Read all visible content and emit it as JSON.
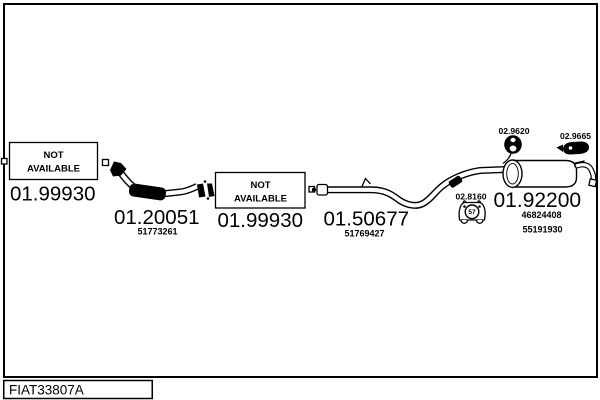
{
  "colors": {
    "ink": "#000000",
    "background": "#ffffff"
  },
  "footer": {
    "drawing_code": "FIAT33807A"
  },
  "not_available": {
    "line1": "NOT",
    "line2": "AVAILABLE"
  },
  "parts": {
    "front_flange": {
      "code": "01.99930"
    },
    "front_pipe": {
      "code": "01.20051",
      "oem": "51773261"
    },
    "mid_gasket": {
      "code": "01.99930"
    },
    "centre_pipe": {
      "code": "01.50677",
      "oem": "51769427"
    },
    "rear_silencer": {
      "code": "01.92200",
      "oem_1": "46824408",
      "oem_2": "55191930"
    },
    "rubber_grommet": {
      "code": "02.9620"
    },
    "clamp": {
      "code": "02.9665"
    },
    "rubber_hanger": {
      "code": "02.8160",
      "stamp": "57"
    }
  }
}
